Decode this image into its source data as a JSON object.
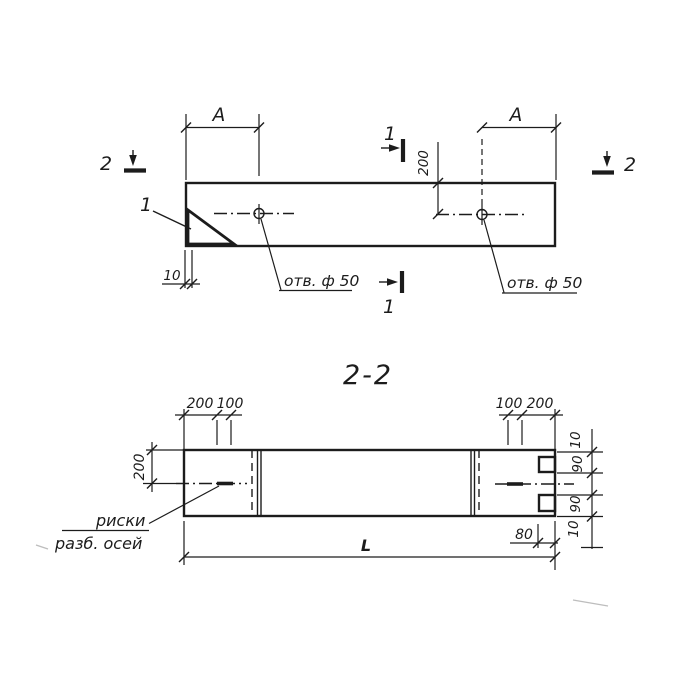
{
  "plan": {
    "dim_a_left": "A",
    "dim_a_right": "A",
    "dim_hole_offset": "200",
    "dim_end_gap": "10",
    "hole_label_left": "отв. ф 50",
    "hole_label_right": "отв. ф 50",
    "detail_mark": "1",
    "cut_1_top": "1",
    "cut_1_bottom": "1",
    "cut_2_left": "2",
    "cut_2_right": "2"
  },
  "section": {
    "title": "2-2",
    "dim_top_left_200": "200",
    "dim_top_left_100": "100",
    "dim_top_right_100": "100",
    "dim_top_right_200": "200",
    "dim_height_200": "200",
    "dim_right_10_top": "10",
    "dim_right_90_top": "90",
    "dim_right_90_bottom": "90",
    "dim_right_10_bottom": "10",
    "dim_80": "80",
    "dim_length": "L",
    "axis_note_line1": "риски",
    "axis_note_line2": "разб. осей"
  },
  "colors": {
    "ink": "#1c1c1c",
    "paper": "#ffffff"
  }
}
